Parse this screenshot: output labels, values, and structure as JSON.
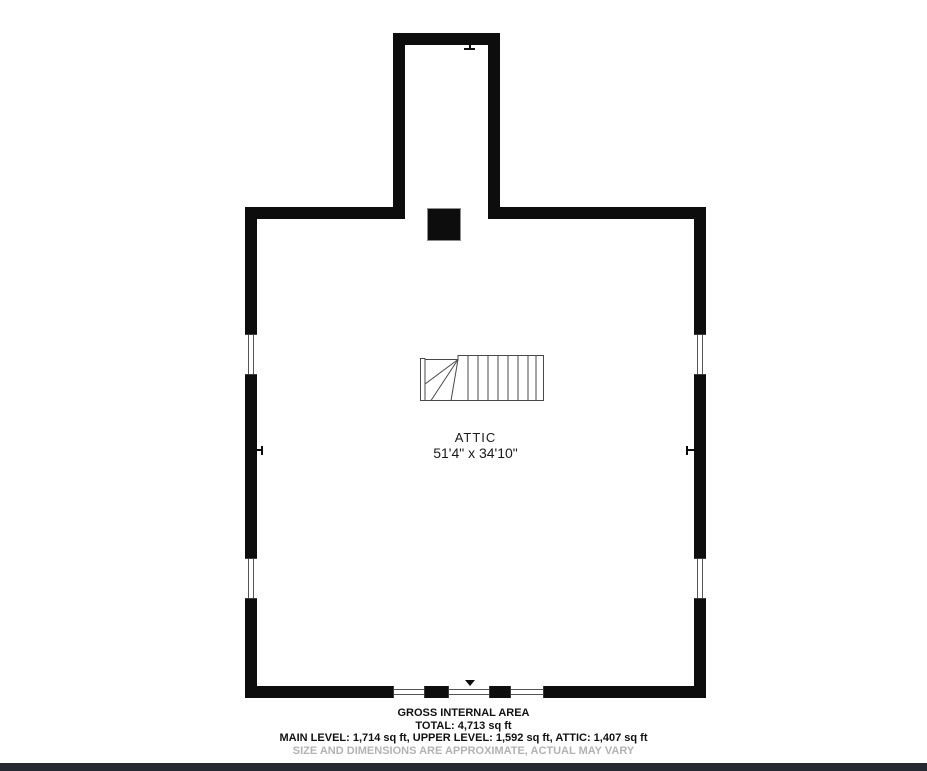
{
  "plan": {
    "room": {
      "name": "ATTIC",
      "dimensions": "51'4\" x 34'10\""
    }
  },
  "footer": {
    "title": "GROSS INTERNAL AREA",
    "total": "TOTAL: 4,713 sq ft",
    "levels": "MAIN LEVEL: 1,714 sq ft, UPPER LEVEL: 1,592 sq ft, ATTIC: 1,407 sq ft",
    "disclaimer": "SIZE AND DIMENSIONS ARE APPROXIMATE, ACTUAL MAY VARY"
  },
  "colors": {
    "wall": "#0d0d0d",
    "stair_line": "#4a4a4a",
    "chimney_fill": "#0d0d0d",
    "disclaimer_text": "#b3b3b3",
    "bottom_bar": "#262832",
    "background": "#ffffff"
  }
}
